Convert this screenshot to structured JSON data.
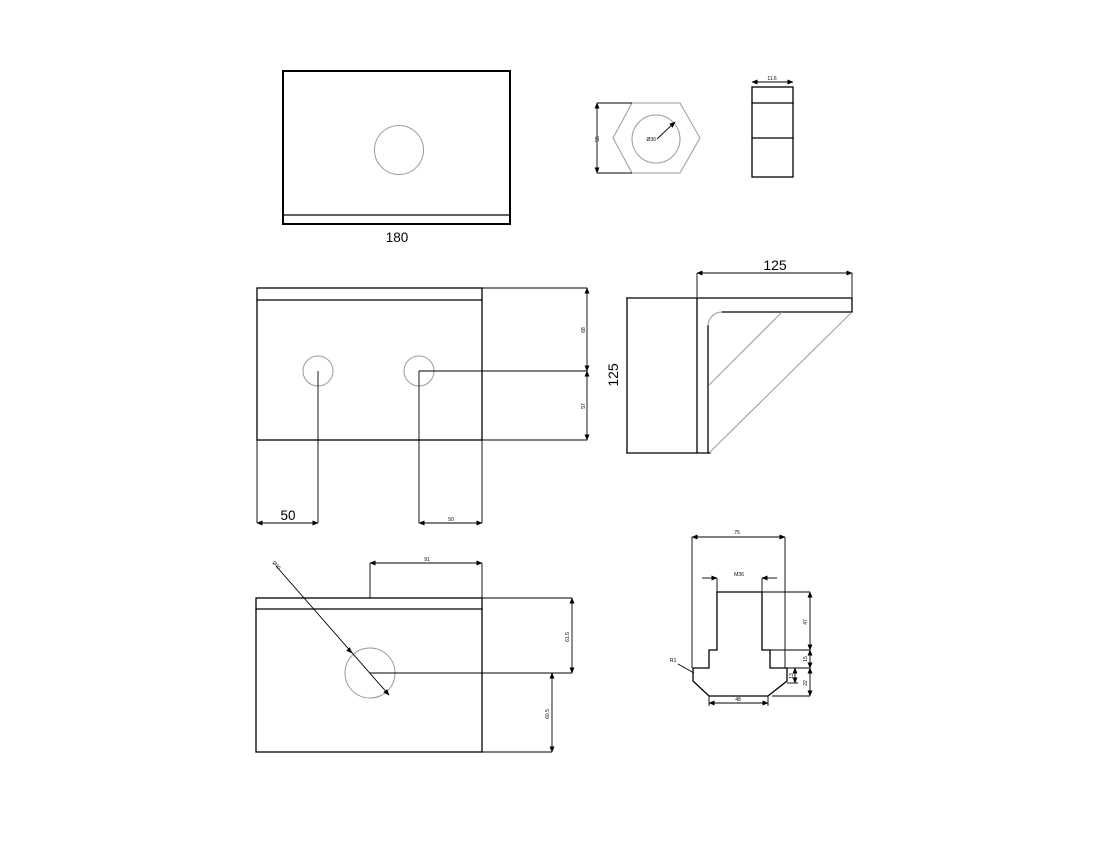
{
  "drawing": {
    "type": "mechanical-engineering-multiview",
    "line_color": "#000000",
    "construction_color": "#9b9b9b",
    "background": "#ffffff",
    "views": {
      "plate_top": {
        "width": "180"
      },
      "hex_front": {
        "across_flats": "55",
        "bore": "Ø36"
      },
      "hex_side": {
        "width": "11.6"
      },
      "bracket_plan": {
        "hole_offset_left": "50",
        "edge_upper": "68",
        "edge_lower": "57",
        "hole_offset_right": "50"
      },
      "bracket_side": {
        "depth": "125",
        "height": "125"
      },
      "plate_front": {
        "slot_width": "91",
        "upper_height": "61.5",
        "lower_height": "60.5",
        "hole_dia": "Ø40"
      },
      "boss_section": {
        "width": "75",
        "thread": "M36",
        "fillet": "R1",
        "base_width": "48",
        "stem_height": "47",
        "step_height": "15",
        "base_height": "22",
        "lip": "13"
      }
    }
  }
}
